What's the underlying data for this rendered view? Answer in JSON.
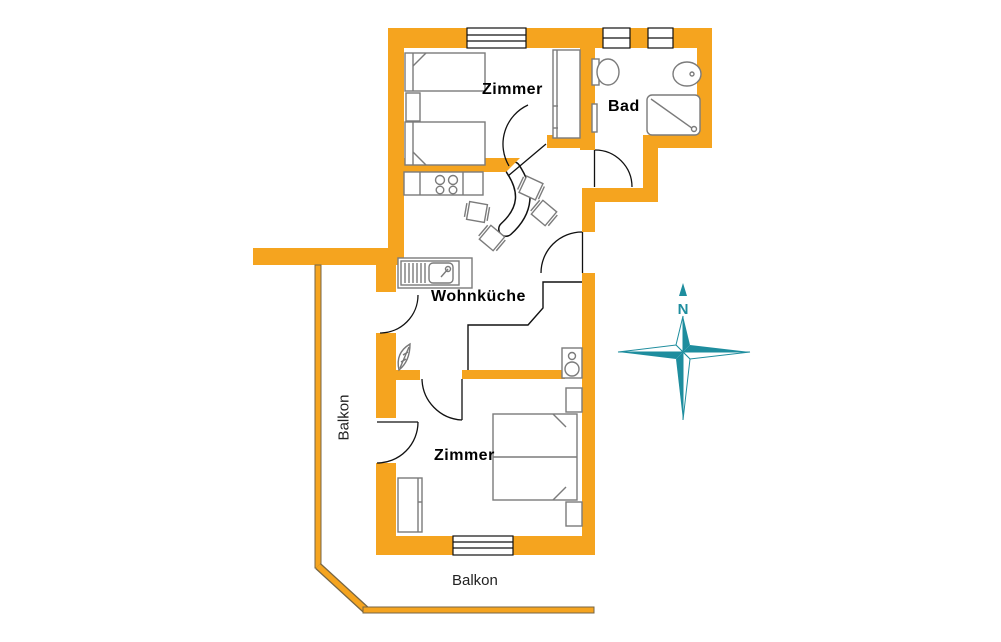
{
  "diagram": {
    "type": "floor-plan",
    "language": "de"
  },
  "colors": {
    "wall": "#F5A41F",
    "compass": "#1E8D9E",
    "furniture_line": "#7b7b7b",
    "door_line": "#111111"
  },
  "rooms": {
    "zimmer_top": "Zimmer",
    "bad": "Bad",
    "wohnkueche": "Wohnküche",
    "zimmer_bottom": "Zimmer"
  },
  "balcony": {
    "left": "Balkon",
    "bottom": "Balkon"
  },
  "compass": {
    "north_label": "N"
  }
}
